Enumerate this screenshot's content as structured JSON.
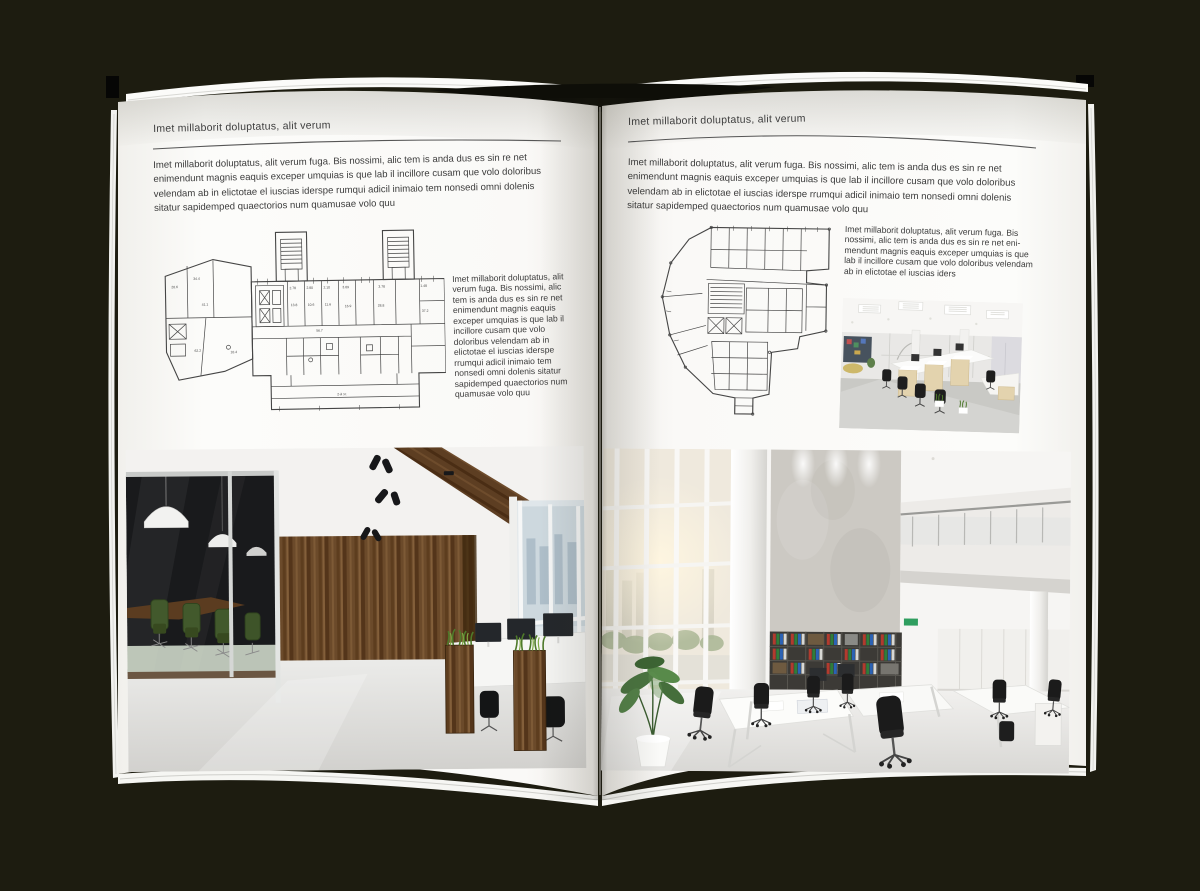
{
  "meta": {
    "background_color": "#1d1c10",
    "page_color": "#fbfaf8",
    "text_color": "#3c3c3c",
    "plan_line_color": "#454545",
    "wood_accent": "#6b4a2a",
    "plant_green": "#4e7a2a"
  },
  "left_page": {
    "kicker": "Imet millaborit doluptatus, alit verum",
    "intro": "Imet millaborit doluptatus, alit verum fuga. Bis nossimi, alic tem is anda dus es sin re net enimendunt magnis eaquis exceper umquias is que lab il incillore cusam que volo doloribus velendam ab in elictotae el iuscias iderspe rumqui adicil inimaio tem nonsedi omni dolenis sitatur sapidemped quaectorios num quamusae volo quu",
    "caption": "Imet millaborit doluptatus, alit verum fuga. Bis nossimi, alic tem is anda dus es sin re net enimendunt magnis eaquis exceper umquias is que lab il incillore cusam que volo doloribus velendam ab in elictotae el iuscias iderspe rrumqui adicil inimaio tem nonsedi omni dolenis sitatur sapidemped quaectorios num quamusae volo quu"
  },
  "right_page": {
    "kicker": "Imet millaborit doluptatus, alit verum",
    "intro": "Imet millaborit doluptatus, alit verum fuga. Bis nossimi, alic tem is anda dus es sin re net enimendunt magnis eaquis exceper umquias is que lab il incillore cusam que volo doloribus velendam ab in elictotae el iuscias iderspe rrumqui adicil inimaio tem nonsedi omni dolenis sitatur sapidemped quaectorios num quamusae volo quu",
    "caption": "Imet millaborit doluptatus, alit verum fuga. Bis nossimi, alic tem is anda dus es sin re net eni-mendunt magnis eaquis exceper umquias is que lab il incillore cusam que volo doloribus velendam ab in elictotae el iuscias iders"
  },
  "left_plan_labels": [
    "2.78",
    "2.80",
    "2.10",
    "3.09",
    "3.78",
    "1.48",
    "13.8",
    "10.6",
    "11.6",
    "16.9",
    "28.8",
    "37.2",
    "20.6",
    "34.4",
    "41.1",
    "62.2",
    "10.4",
    "56.7",
    "2-й эт."
  ]
}
